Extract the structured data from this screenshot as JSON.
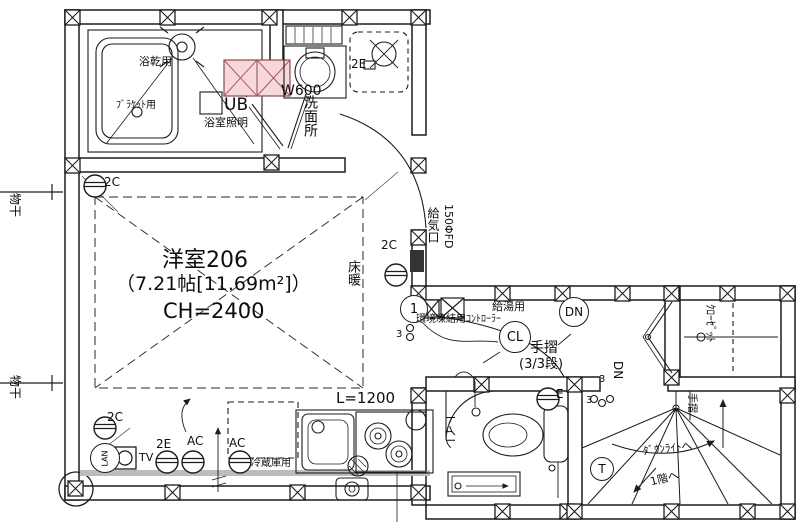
{
  "bathroom": {
    "dryer": "浴乾用",
    "bracket": "ﾌﾞﾗｹｯﾄ用",
    "ub": "UB",
    "light": "浴室照明"
  },
  "washroom": {
    "name": "洗面所",
    "width": "W600",
    "outlet2e": "2E"
  },
  "room": {
    "name": "洋室206",
    "area": "（7.21帖[11.69m²]）",
    "ch": "CH=2400",
    "floor_heating": "床暖"
  },
  "exterior": {
    "laundry1": "物干",
    "laundry2": "物干",
    "vent": "給気口",
    "vent_size": "150ΦFD"
  },
  "outlets": {
    "c_top": "2C",
    "c_right": "2C",
    "c_bottom": "2C",
    "e_bottom": "2E",
    "ac1": "AC",
    "ac2": "AC",
    "tv": "TV",
    "lan": "LAN",
    "e_toilet": "E"
  },
  "hall": {
    "one": "1",
    "kyuto": "給湯用",
    "controller": "環境凍結用ｺﾝﾄﾛｰﾗｰ",
    "cl": "CL",
    "dn": "DN",
    "tesuri": "手摺",
    "steps": "(3/3段)",
    "sw3a": "3",
    "sw3b": "3",
    "sw3c": "3"
  },
  "kitchen": {
    "length": "L=1200",
    "fridge": "冷蔵庫用"
  },
  "toilet": {
    "name": "トイレ"
  },
  "closet": {
    "name": "ｸﾛｰｾﾞｯﾄ"
  },
  "stairs": {
    "dn": "DN",
    "tesuri": "手摺",
    "downlight": "ﾀﾞｳﾝﾗｲﾄへ",
    "to_first": "1階へ",
    "t": "T"
  }
}
